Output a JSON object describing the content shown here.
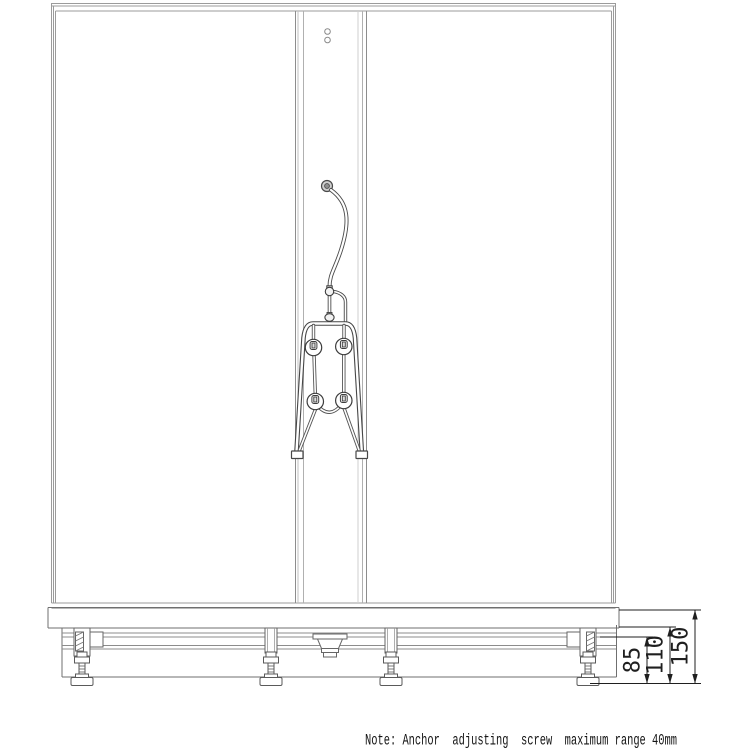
{
  "page": {
    "width": 750,
    "height": 750,
    "background": "#ffffff"
  },
  "drawing": {
    "kind": "technical-line-drawing",
    "subject": "Shower enclosure front elevation with base frame and adjustable anchor feet",
    "note_text": "Note: Anchor  adjusting  screw  maximum range 40mm",
    "dimensions": [
      {
        "id": "dim-85",
        "label": "85"
      },
      {
        "id": "dim-110",
        "label": "110"
      },
      {
        "id": "dim-150",
        "label": "150"
      }
    ],
    "colors": {
      "background": "#ffffff",
      "frame_line": "#9b9b9b",
      "panel_line": "#a8a8a8",
      "base_line": "#6f6f6f",
      "fixture_line": "#454545",
      "dimension_line": "#1f1f1f",
      "text": "#141414"
    }
  }
}
